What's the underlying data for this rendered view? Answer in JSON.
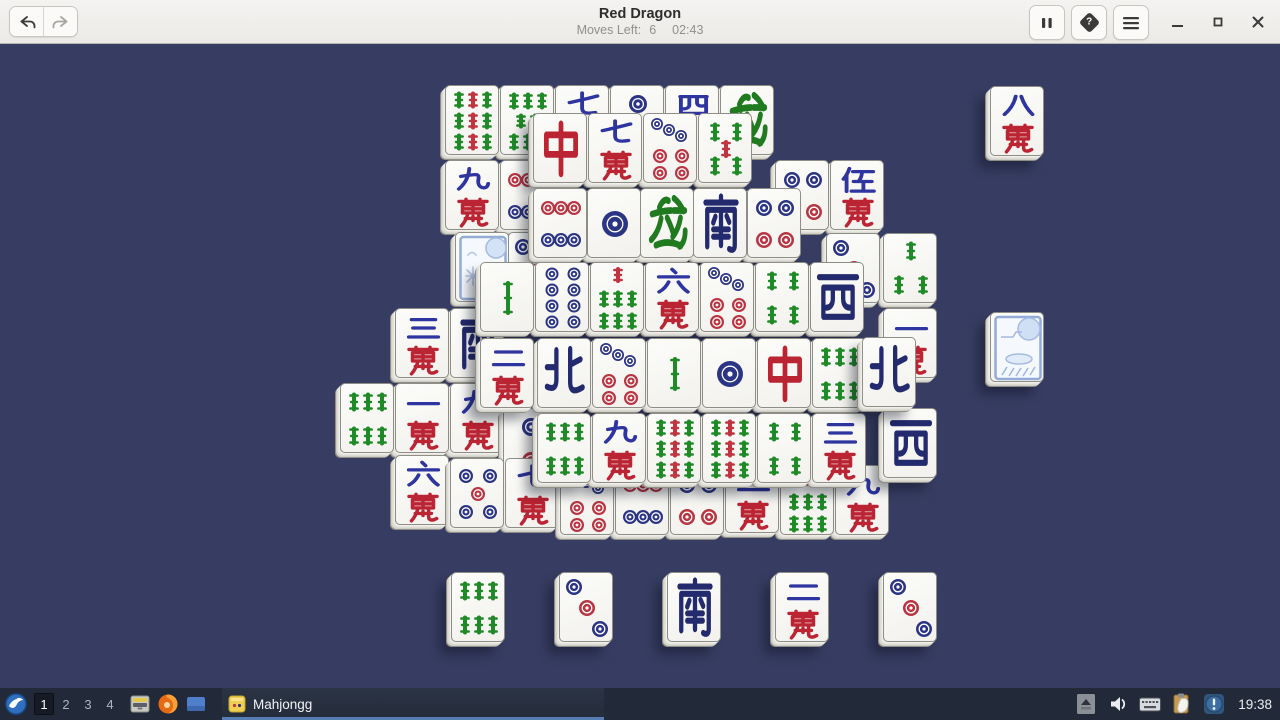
{
  "header": {
    "title": "Red Dragon",
    "moves_label": "Moves Left:",
    "moves_value": "6",
    "time": "02:43",
    "buttons": {
      "undo": "undo",
      "redo": "redo",
      "pause": "pause",
      "hint": "hint",
      "menu": "menu",
      "minimize": "minimize",
      "maximize": "maximize",
      "close": "close"
    }
  },
  "game": {
    "background": "#373d62",
    "faces": {
      "bamboo-1": "1 Bamboo",
      "bamboo-3": "3 Bamboo",
      "bamboo-4": "4 Bamboo",
      "bamboo-5": "5 Bamboo",
      "bamboo-6": "6 Bamboo",
      "bamboo-7": "7 Bamboo",
      "bamboo-8": "8 Bamboo",
      "bamboo-9": "9 Bamboo",
      "circle-1": "1 Circle",
      "circle-2": "2 Circles",
      "circle-3": "3 Circles",
      "circle-4": "4 Circles",
      "circle-5": "5 Circles",
      "circle-6": "6 Circles",
      "circle-7": "7 Circles",
      "circle-8": "8 Circles",
      "char-1": "一萬",
      "char-2": "二萬",
      "char-3": "三萬",
      "char-4": "四萬",
      "char-5": "伍萬",
      "char-6": "六萬",
      "char-7": "七萬",
      "char-8": "八萬",
      "char-9": "九萬",
      "wind-south": "南",
      "wind-north": "北",
      "wind-west": "西",
      "dragon-red": "中",
      "dragon-green": "發",
      "flower": "Flower",
      "season": "Season"
    },
    "tiles": [
      {
        "face": "dragon-green",
        "x": 720,
        "y": 85,
        "layer": 1
      },
      {
        "face": "char-4",
        "x": 665,
        "y": 85,
        "layer": 1
      },
      {
        "face": "circle-2",
        "x": 610,
        "y": 85,
        "layer": 1
      },
      {
        "face": "char-7",
        "x": 555,
        "y": 85,
        "layer": 1
      },
      {
        "face": "bamboo-8",
        "x": 500,
        "y": 85,
        "layer": 1
      },
      {
        "face": "bamboo-9",
        "x": 445,
        "y": 85,
        "layer": 1
      },
      {
        "face": "char-5",
        "x": 830,
        "y": 160,
        "layer": 1
      },
      {
        "face": "circle-4",
        "x": 775,
        "y": 160,
        "layer": 1
      },
      {
        "face": "circle-6",
        "x": 500,
        "y": 160,
        "layer": 1
      },
      {
        "face": "char-9",
        "x": 445,
        "y": 160,
        "layer": 1
      },
      {
        "face": "bamboo-3",
        "x": 883,
        "y": 233,
        "layer": 1
      },
      {
        "face": "circle-3",
        "x": 826,
        "y": 233,
        "layer": 1
      },
      {
        "face": "circle-3",
        "x": 508,
        "y": 232,
        "layer": 1
      },
      {
        "face": "flower",
        "x": 455,
        "y": 232,
        "layer": 1
      },
      {
        "face": "char-1",
        "x": 883,
        "y": 308,
        "layer": 1
      },
      {
        "face": "wind-south",
        "x": 450,
        "y": 308,
        "layer": 1
      },
      {
        "face": "char-3",
        "x": 395,
        "y": 308,
        "layer": 1
      },
      {
        "face": "char-9",
        "x": 450,
        "y": 383,
        "layer": 1
      },
      {
        "face": "char-1",
        "x": 395,
        "y": 383,
        "layer": 1
      },
      {
        "face": "bamboo-6",
        "x": 340,
        "y": 383,
        "layer": 1
      },
      {
        "face": "circle-2",
        "x": 503,
        "y": 408,
        "layer": 1
      },
      {
        "face": "char-6",
        "x": 395,
        "y": 455,
        "layer": 1
      },
      {
        "face": "char-7",
        "x": 505,
        "y": 458,
        "layer": 1
      },
      {
        "face": "circle-5",
        "x": 450,
        "y": 458,
        "layer": 1
      },
      {
        "face": "char-9",
        "x": 835,
        "y": 465,
        "layer": 1
      },
      {
        "face": "bamboo-7",
        "x": 780,
        "y": 465,
        "layer": 1
      },
      {
        "face": "char-2",
        "x": 725,
        "y": 463,
        "layer": 1
      },
      {
        "face": "circle-4",
        "x": 670,
        "y": 465,
        "layer": 1
      },
      {
        "face": "circle-6",
        "x": 615,
        "y": 465,
        "layer": 1
      },
      {
        "face": "circle-7",
        "x": 560,
        "y": 465,
        "layer": 1
      },
      {
        "face": "bamboo-5",
        "x": 698,
        "y": 113,
        "layer": 2
      },
      {
        "face": "circle-7",
        "x": 643,
        "y": 113,
        "layer": 2
      },
      {
        "face": "char-7",
        "x": 588,
        "y": 113,
        "layer": 2
      },
      {
        "face": "dragon-red",
        "x": 533,
        "y": 113,
        "layer": 2
      },
      {
        "face": "circle-4",
        "x": 747,
        "y": 188,
        "layer": 2
      },
      {
        "face": "wind-south",
        "x": 693,
        "y": 188,
        "layer": 2
      },
      {
        "face": "dragon-green",
        "x": 640,
        "y": 188,
        "layer": 2
      },
      {
        "face": "circle-1",
        "x": 587,
        "y": 188,
        "layer": 2
      },
      {
        "face": "circle-6",
        "x": 533,
        "y": 188,
        "layer": 2
      },
      {
        "face": "wind-west",
        "x": 810,
        "y": 262,
        "layer": 3
      },
      {
        "face": "bamboo-4",
        "x": 755,
        "y": 262,
        "layer": 3
      },
      {
        "face": "circle-7",
        "x": 700,
        "y": 262,
        "layer": 3
      },
      {
        "face": "char-6",
        "x": 645,
        "y": 262,
        "layer": 3
      },
      {
        "face": "bamboo-7",
        "x": 590,
        "y": 262,
        "layer": 3
      },
      {
        "face": "circle-8",
        "x": 535,
        "y": 262,
        "layer": 3
      },
      {
        "face": "bamboo-1",
        "x": 480,
        "y": 262,
        "layer": 3
      },
      {
        "face": "wind-west",
        "x": 883,
        "y": 408,
        "layer": 3
      },
      {
        "face": "bamboo-6",
        "x": 812,
        "y": 338,
        "layer": 3
      },
      {
        "face": "dragon-red",
        "x": 757,
        "y": 338,
        "layer": 3
      },
      {
        "face": "circle-1",
        "x": 702,
        "y": 338,
        "layer": 3
      },
      {
        "face": "bamboo-1",
        "x": 647,
        "y": 338,
        "layer": 3
      },
      {
        "face": "circle-7",
        "x": 592,
        "y": 338,
        "layer": 3
      },
      {
        "face": "wind-north",
        "x": 537,
        "y": 338,
        "layer": 3
      },
      {
        "face": "char-3",
        "x": 812,
        "y": 413,
        "layer": 3
      },
      {
        "face": "bamboo-4",
        "x": 757,
        "y": 413,
        "layer": 3
      },
      {
        "face": "bamboo-9",
        "x": 702,
        "y": 413,
        "layer": 3
      },
      {
        "face": "bamboo-9",
        "x": 647,
        "y": 413,
        "layer": 3
      },
      {
        "face": "char-9",
        "x": 592,
        "y": 413,
        "layer": 3
      },
      {
        "face": "bamboo-6",
        "x": 537,
        "y": 413,
        "layer": 3
      },
      {
        "face": "wind-north",
        "x": 862,
        "y": 337,
        "layer": 4
      },
      {
        "face": "char-2",
        "x": 480,
        "y": 338,
        "layer": 4
      },
      {
        "face": "char-8",
        "x": 990,
        "y": 86,
        "layer": 0
      },
      {
        "face": "season",
        "x": 990,
        "y": 312,
        "layer": 0
      },
      {
        "face": "bamboo-6",
        "x": 451,
        "y": 572,
        "layer": 0
      },
      {
        "face": "circle-3",
        "x": 559,
        "y": 572,
        "layer": 0
      },
      {
        "face": "wind-south",
        "x": 667,
        "y": 572,
        "layer": 0
      },
      {
        "face": "char-2",
        "x": 775,
        "y": 572,
        "layer": 0
      },
      {
        "face": "circle-3",
        "x": 883,
        "y": 572,
        "layer": 0
      }
    ]
  },
  "taskbar": {
    "workspaces": [
      "1",
      "2",
      "3",
      "4"
    ],
    "active_workspace": "1",
    "launcher_icons": [
      "whisker-menu-icon",
      "file-manager-icon",
      "firefox-icon",
      "window-icon"
    ],
    "window_button": "Mahjongg",
    "tray_icons": [
      "panel-expand-icon",
      "volume-icon",
      "keyboard-icon",
      "clipboard-icon",
      "notification-icon"
    ],
    "clock": "19:38"
  },
  "colors": {
    "background": "#373d62",
    "tile_face": "#f8f7f4",
    "suit_blue": "#2e34a0",
    "wind_navy": "#232a6e",
    "suit_red": "#bb2433",
    "suit_green": "#1f8a27",
    "dot_blue": "#2c3584",
    "dot_red": "#b93541",
    "taskbar_bg": "#222a39",
    "active_task_underline": "#567eb5"
  }
}
